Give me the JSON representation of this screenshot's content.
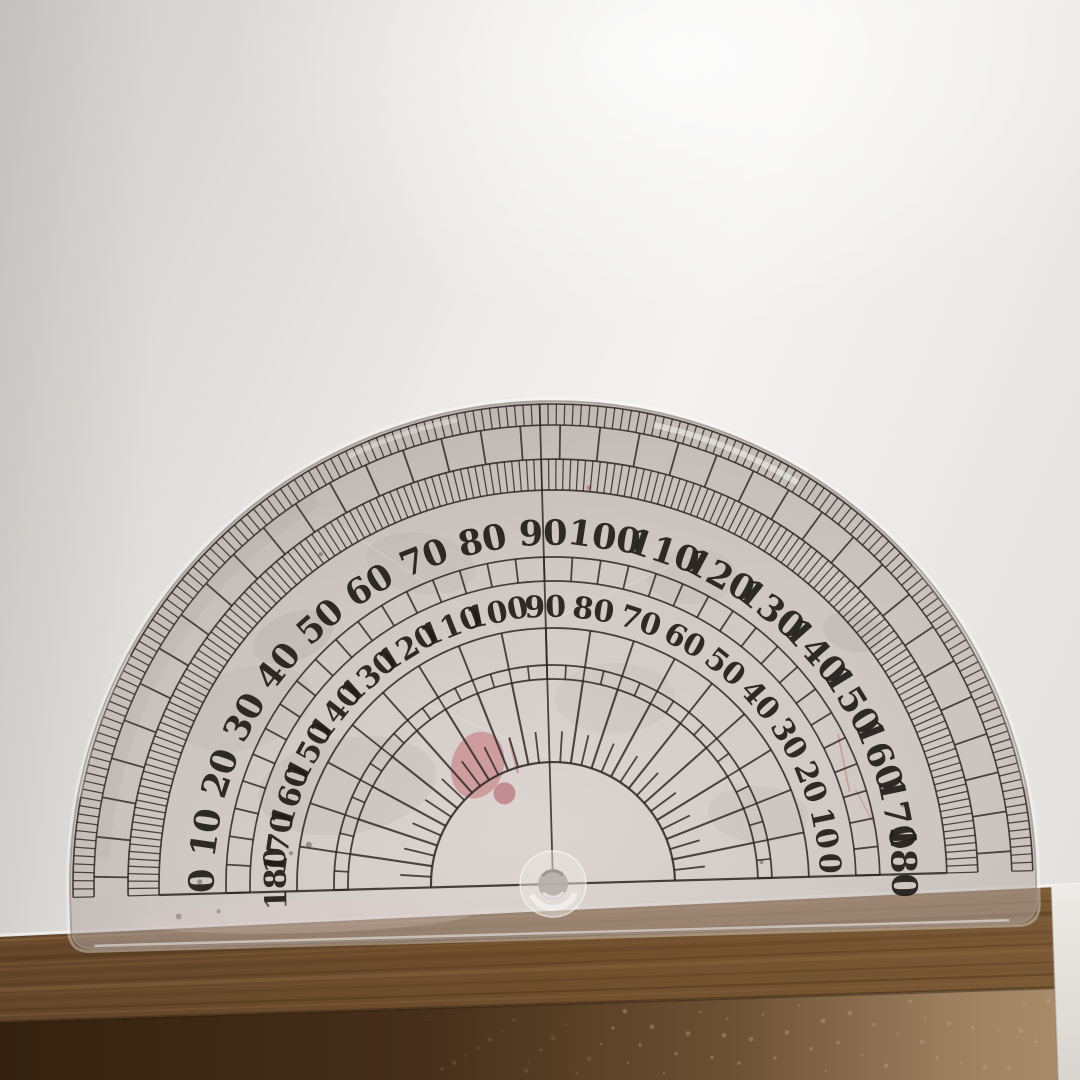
{
  "protractor": {
    "outer_labels": [
      "0",
      "10",
      "20",
      "30",
      "40",
      "50",
      "60",
      "70",
      "80",
      "90",
      "100",
      "110",
      "120",
      "130",
      "140",
      "150",
      "160",
      "170",
      "180"
    ],
    "inner_labels": [
      "180",
      "170",
      "160",
      "150",
      "140",
      "130",
      "120",
      "110",
      "100",
      "90",
      "80",
      "70",
      "60",
      "50",
      "40",
      "30",
      "20",
      "10",
      "0"
    ],
    "geometry": {
      "cx": 553,
      "cy": 884,
      "tilt_deg": -1.6,
      "outer_radius": 483,
      "skirt": 52,
      "corner_r": 22,
      "hole_r": 15,
      "chamfer_r": 33,
      "rings": {
        "edge_arc": 480,
        "fine_outer": [
          459,
          480
        ],
        "brick": [
          425,
          459
        ],
        "fine_inner": [
          394,
          425
        ],
        "cell_band": [
          303,
          327
        ],
        "arc_below_inner": 256,
        "ten_band": [
          219,
          256
        ],
        "five_band": [
          205,
          219
        ],
        "spokes": [
          122,
          205
        ],
        "minor_ticks": [
          122,
          153
        ],
        "inner_arc": 122,
        "baseline_half": 394,
        "line90_top": 480
      },
      "labels": {
        "outer_feet": 339,
        "outer_size": 35,
        "inner_feet": 267,
        "inner_size": 30,
        "end_lift": 13
      },
      "steps": {
        "fine": 1,
        "brick": 5,
        "brick_offset": 2.5,
        "cell": 5,
        "ten": 10,
        "five": 5,
        "spoke": 10,
        "minor": 5
      }
    },
    "colors": {
      "ink": "#2b2522",
      "label_ink": "#1f1b18",
      "plastic_core": "rgba(198,186,182,0.50)",
      "plastic_mid": "rgba(178,166,162,0.55)",
      "plastic_edge_fill": "rgba(158,146,142,0.62)",
      "plastic_edge_line": "#9e948e",
      "highlight": "#ffffff"
    },
    "blemishes": {
      "red_stain": {
        "x": 481,
        "y": 763,
        "rx": 26,
        "ry": 34,
        "rot": 18,
        "fill": "#bc4850",
        "op": 0.38
      },
      "red_blob": {
        "x": 507,
        "y": 792,
        "r": 11,
        "fill": "#a33a44",
        "op": 0.45
      },
      "red_lines": [
        {
          "x1": 513,
          "y1": 737,
          "x2": 521,
          "y2": 772,
          "w": 2.0,
          "op": 0.5
        },
        {
          "x1": 842,
          "y1": 742,
          "x2": 852,
          "y2": 800,
          "w": 1.6,
          "op": 0.38
        },
        {
          "x1": 858,
          "y1": 798,
          "x2": 876,
          "y2": 834,
          "w": 1.4,
          "op": 0.3
        }
      ],
      "red_dots": [
        {
          "x": 600,
          "y": 489,
          "r": 2.5,
          "op": 0.5
        },
        {
          "x": 835,
          "y": 690,
          "r": 2.0,
          "op": 0.4
        }
      ],
      "mottles": [
        {
          "x": 300,
          "y": 630,
          "rx": 42,
          "ry": 24,
          "rot": -20,
          "op": 0.12
        },
        {
          "x": 430,
          "y": 560,
          "rx": 55,
          "ry": 30,
          "rot": 10,
          "op": 0.08
        },
        {
          "x": 700,
          "y": 580,
          "rx": 45,
          "ry": 28,
          "rot": 0,
          "op": 0.08
        },
        {
          "x": 860,
          "y": 640,
          "rx": 30,
          "ry": 20,
          "rot": 15,
          "op": 0.1
        },
        {
          "x": 620,
          "y": 700,
          "rx": 60,
          "ry": 35,
          "rot": 0,
          "op": 0.07
        },
        {
          "x": 350,
          "y": 780,
          "rx": 90,
          "ry": 48,
          "rot": -8,
          "op": 0.1
        },
        {
          "x": 250,
          "y": 700,
          "rx": 70,
          "ry": 40,
          "rot": -15,
          "op": 0.08
        },
        {
          "x": 760,
          "y": 820,
          "rx": 50,
          "ry": 28,
          "rot": 5,
          "op": 0.08
        }
      ],
      "dark_specks": [
        {
          "x": 310,
          "y": 838,
          "r": 3.0
        },
        {
          "x": 292,
          "y": 846,
          "r": 2.0
        },
        {
          "x": 200,
          "y": 872,
          "r": 2.5
        },
        {
          "x": 178,
          "y": 906,
          "r": 3.0
        },
        {
          "x": 762,
          "y": 868,
          "r": 2.0
        },
        {
          "x": 905,
          "y": 815,
          "r": 2.0
        },
        {
          "x": 330,
          "y": 548,
          "r": 2.2
        },
        {
          "x": 218,
          "y": 902,
          "r": 2.2
        }
      ],
      "scratches": [
        {
          "x1": 350,
          "y1": 520,
          "x2": 520,
          "y2": 640
        },
        {
          "x1": 560,
          "y1": 620,
          "x2": 700,
          "y2": 560
        },
        {
          "x1": 820,
          "y1": 560,
          "x2": 900,
          "y2": 640
        },
        {
          "x1": 430,
          "y1": 700,
          "x2": 560,
          "y2": 760
        }
      ]
    }
  },
  "background": {
    "wood": {
      "top_edge": {
        "x1": 0,
        "y1": 937,
        "x2": 1080,
        "y2": 886
      },
      "face_edge": {
        "y_left": 1022,
        "y_right": 987
      },
      "top_colors": [
        "#63452a",
        "#6f4e2c",
        "#7b5a36"
      ],
      "grain_colors": [
        "#7b5733",
        "#5e3f23",
        "#71502f",
        "#523519",
        "#86643c"
      ],
      "front_colors": [
        "#33220f",
        "#46301b",
        "#6d5134",
        "#9c7f5f",
        "#ab8e6c"
      ],
      "speckle": "#c9ad8c",
      "edge_shadow": "#241708",
      "paper_lip": "#ffffff"
    },
    "right_strip": {
      "x_top": 1051,
      "x_bottom": 1058,
      "fill_top": "#edebe7",
      "fill_bottom": "#d9d5cf"
    }
  }
}
